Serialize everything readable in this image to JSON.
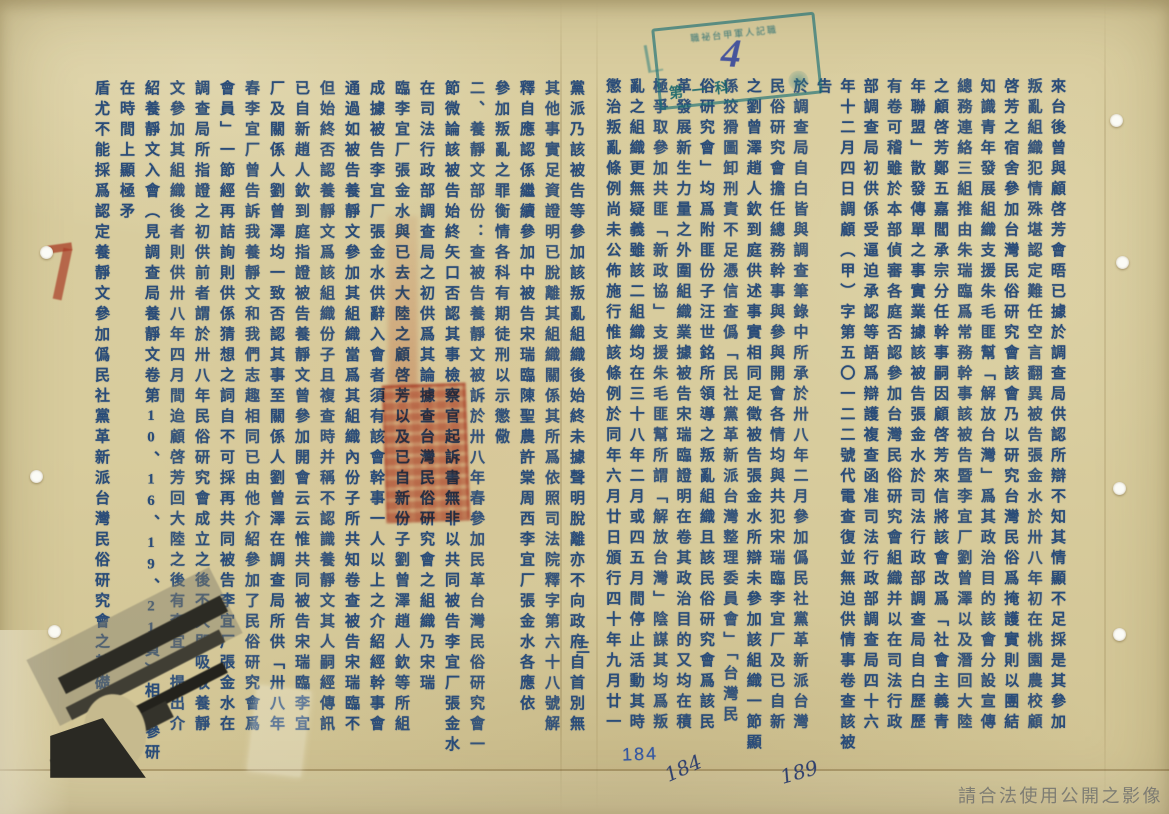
{
  "colors": {
    "paper": "#d8cc9e",
    "ink": "#2a4c78",
    "stamp_teal": "#1a6e76",
    "seal_red": "#c23b27",
    "watermark_gray": "#767670"
  },
  "sheet_number": "三",
  "pages": {
    "right": {
      "columns": [
        "來台後曾與顧啓芳會晤已據於調查局供認所辯不知其情顯不足採是其參加",
        "叛亂組織犯情殊堪認定難任空言翻異被告張金水於卅八年初在桃園農校顧",
        "啓芳之宿舍參加台灣民俗研究會該會乃以研究台灣民俗爲掩護實則以團結",
        "知識青年發展組織支援朱毛匪幫「解放台灣」爲其政治目的該會分設宣傳",
        "總務連絡三組推由朱瑞臨爲常務幹事該被告暨李宜厂劉曾澤以及潛回大陸",
        "之顧啓芳鄭五嘉閻承宗分任幹事嗣因顧啓芳來信將該會改爲「社會主義青",
        "年聯盟」散發傳單之事實業據該被告張金水於司法行政部調查局自白歷歷",
        "有卷可稽雖於本部偵審各庭否認參加台灣民俗研究會組織并以在司法行政",
        "部調查局初供係受逼迫承認等語爲辯護複查函准司法行政部調查局四十六",
        "年十二月四日調顧（甲）字第五〇一二二號代電查復並無迫供情事卷查該被告",
        "於調查局自白皆與調查筆錄中所承於卅八年二月參加僞民社黨革新派台灣",
        "民俗研究會擔任總務幹事與參與開會各情均與共犯宋瑞臨李宜厂及已自新",
        "之劉曾澤趙人欽到庭供述事實相同足徵被告張金水所辯未參加該組織一節顯",
        "係狡猾圖卸刑責不足憑信查僞「民社黨革新派台灣整理委員會」「台灣民",
        "俗研究會」均爲附匪份子汪世銘所領導之叛亂組織且該民俗研究會爲該民",
        "革發展新生力量之外圍組織業據被告宋瑞臨證明在卷其政治目的又均在積",
        "極爭取參加共匪「新政協」支援朱毛匪幫所謂「解放台灣」陰謀其均爲叛",
        "亂之組織更無疑義雖該二組織均在三十八年二月或四五月間停止活動其時",
        "懲治叛亂條例尚未公佈施行惟該條例於同年六月廿日頒行四十年九月廿一",
        "日政府明令公布共匪及附匪份子自首法更列僞民社黨革新派爲附匪叛亂"
      ]
    },
    "left": {
      "columns": [
        "黨派乃該被告等參加該叛亂組織後始終未據聲明脫離亦不向政府自首別無",
        "其他事實足資證明已脫離其組織關係其所爲依照司法院釋字第六十八號解",
        "釋自應認係繼續參加中被告宋瑞臨陳聖農許棠周西李宜厂張金水各應依",
        "參加叛亂之罪衡情各科有期徒刑以示懲儆",
        "二、養靜文部份：查被告養靜文被訴於卅八年春參加民革台灣民俗研究會一",
        "節微論該被告始終矢口否認其事檢察官起訴書無非以共同被告李宜厂張金水",
        "在司法行政部調查局之初供爲其論據查台灣民俗研究會之組織乃宋瑞",
        "臨李宜厂張金水與已去大陸之顧啓芳以及已自新份子劉曾澤趙人欽等所組",
        "成據被告李宜厂張金水供辭入會者須有該會幹事一人以上之介紹經幹事會",
        "通過如被告養靜文參加其組織當爲其組織內份子所共知卷查被告宋瑞臨不",
        "但始終否認養靜文爲該組織份子且複查時并稱不認識養靜文其人嗣經傳訊",
        "已自新趙人欽到庭指證被告養靜文曾參加開會云云惟共同被告宋瑞臨李宜",
        "厂及關係人劉曾澤均一致否認其事至關係人劉曾澤在調查局所供「卅八年",
        "春李宜厂曾告訴我養靜文和我們志趣相同已由他介紹參加了民俗研究會爲",
        "會員」一節經再詰詢則供係猜想之詞自不可採再共同被告李宜厂張金水在",
        "調查局所指證之初供前者謂於卅八年民俗研究會成立之後不久即吸收養靜",
        "文參加其組織後者則供卅八年四月間迨顧啓芳回大陸之後有李宜厂提出介",
        "紹養靜文入會（見調查局養靜文卷第10、16、19、21頁）相互參研在時間上顯極矛",
        "盾尤不能採爲認定養靜文參加僞民社黨革新派台灣民俗研究會之基礎此外",
        "別無其他積極佐證足資認定是被告養靜文犯罪尚屬不能證明應予諭知無罪"
      ]
    }
  },
  "stamp": {
    "top_text": "職祕台甲軍人記職",
    "number": "4",
    "bottom_text": "第一科"
  },
  "annotations": {
    "printed_number": "184",
    "handwritten_number_1": "184",
    "handwritten_number_2": "189"
  },
  "watermark": "請合法使用公開之影像"
}
